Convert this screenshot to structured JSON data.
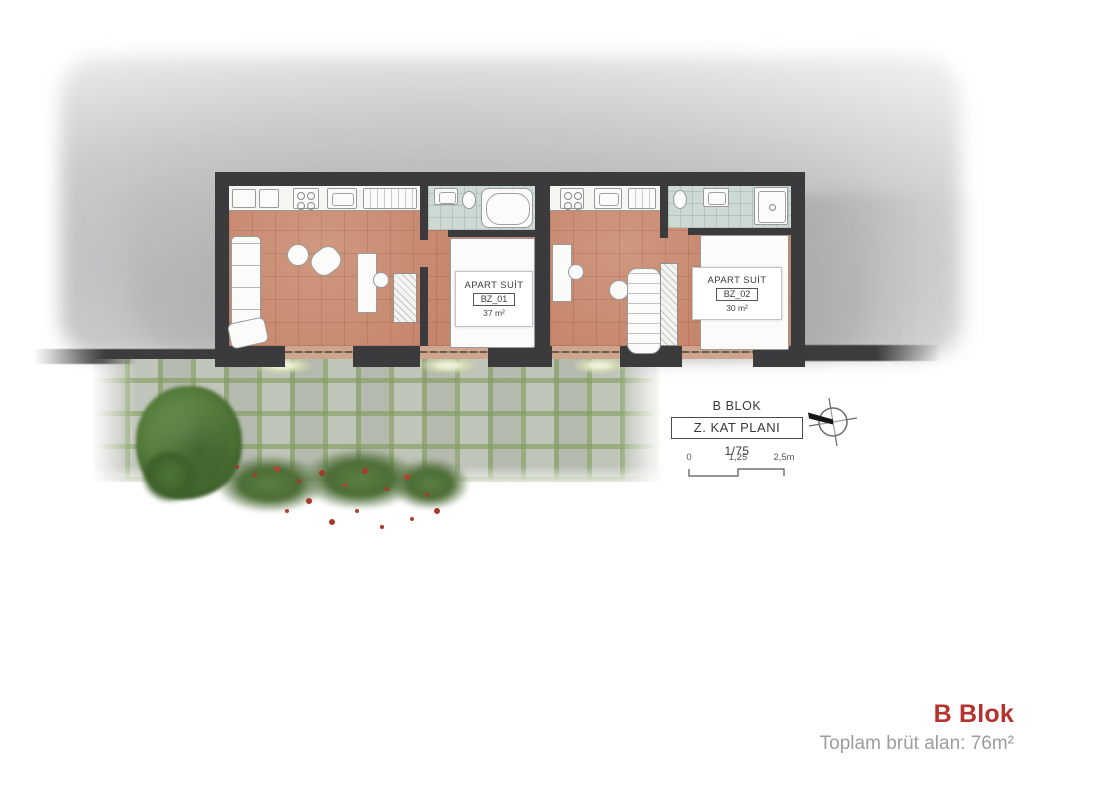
{
  "plan": {
    "apartments": [
      {
        "title": "APART SUİT",
        "code": "BZ_01",
        "area": "37 m²"
      },
      {
        "title": "APART SUİT",
        "code": "BZ_02",
        "area": "30 m²"
      }
    ],
    "title_block": {
      "block": "B BLOK",
      "plan_name": "Z. KAT PLANI",
      "scale": "1/75"
    },
    "scale_bar": {
      "start": "0",
      "mid": "1,25",
      "end": "2,5m"
    }
  },
  "footer": {
    "block_name": "B Blok",
    "total_area": "Toplam brüt alan: 76m²"
  },
  "colors": {
    "accent_red": "#b5322d",
    "muted_text": "#9d9d9d",
    "wall_dark": "#3b3b3d",
    "floor_terracotta": "#c5866b",
    "bathroom_teal": "#cdd9d3",
    "garden_green": "#809c5d",
    "wash_gray": "#b9b9bb"
  },
  "icons": {
    "north_arrow": "north-arrow-icon"
  }
}
